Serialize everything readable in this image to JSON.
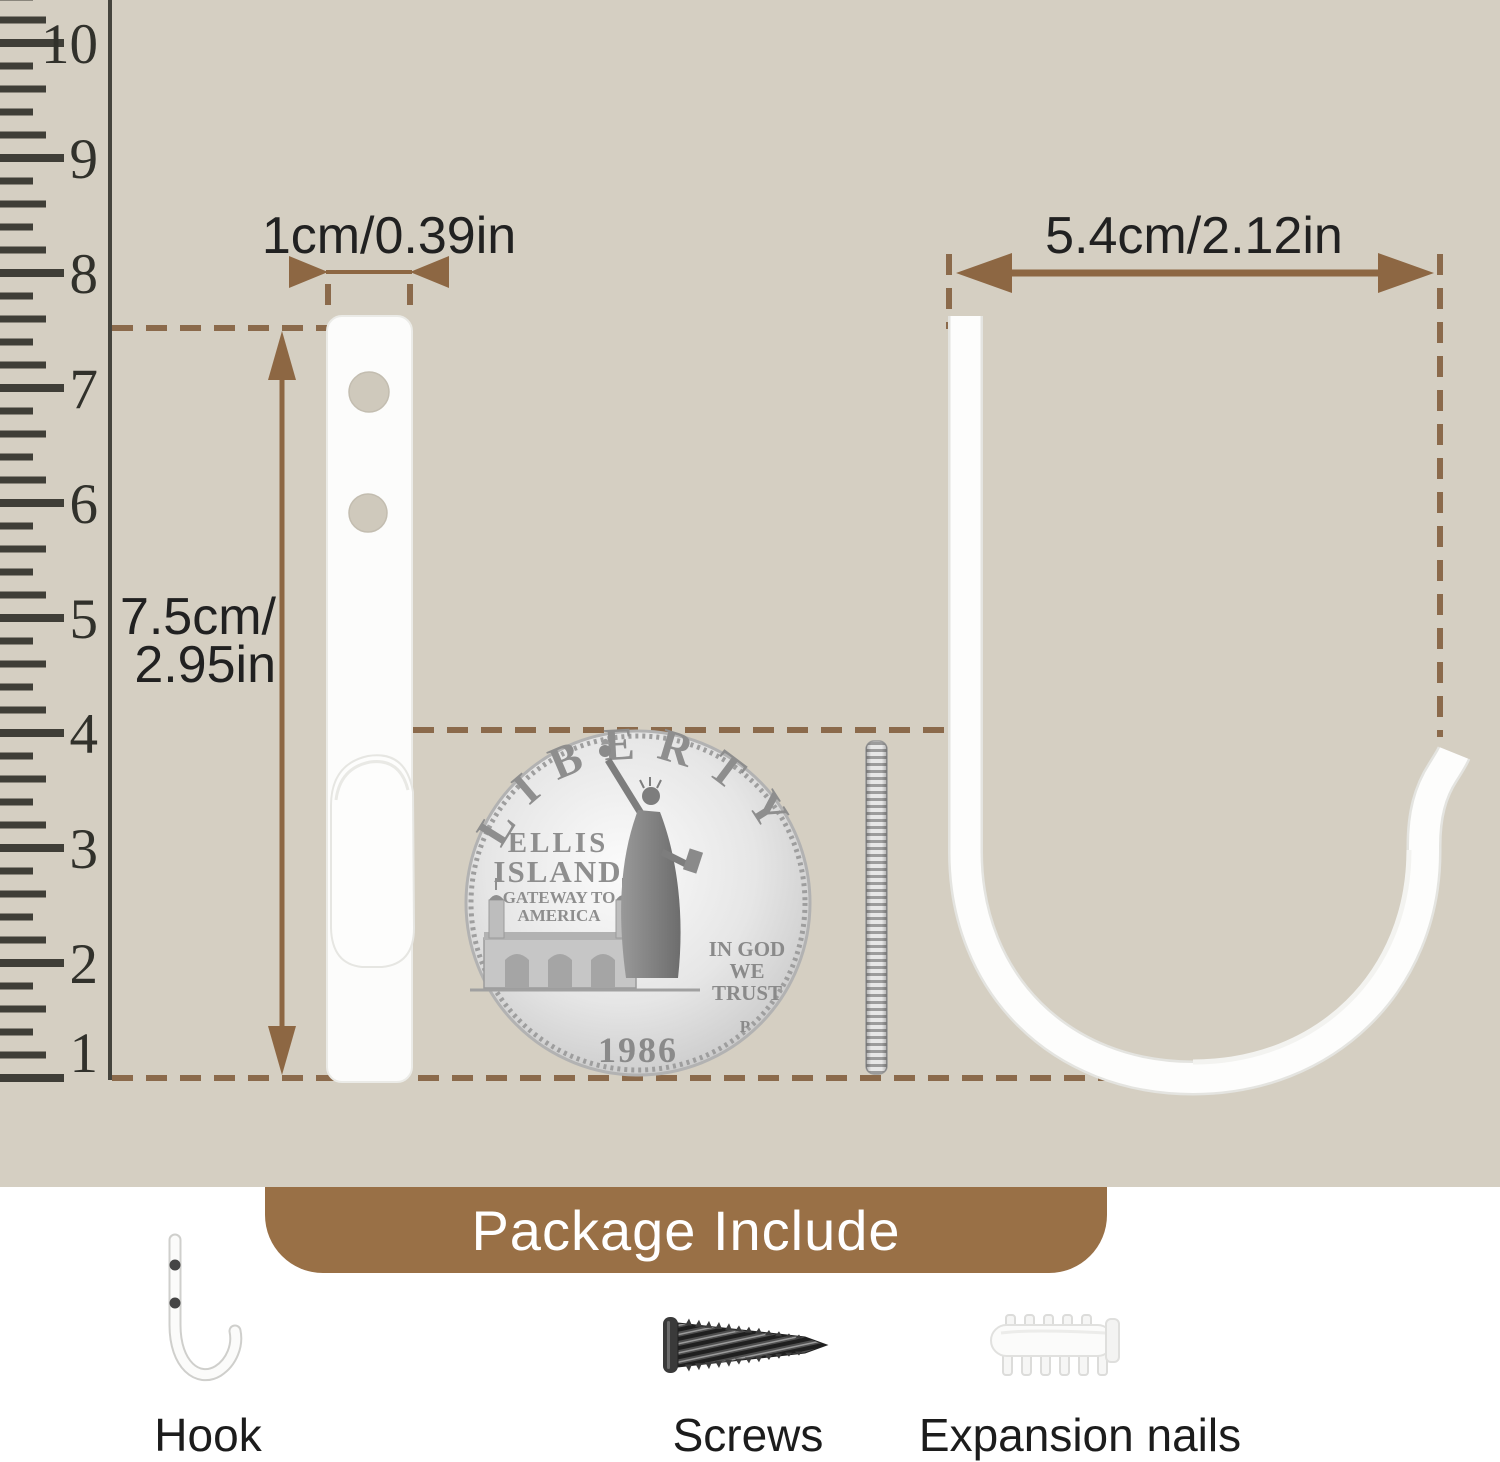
{
  "page": {
    "background_beige": "#d5cfc2"
  },
  "colors": {
    "accent_brown": "#8d6743",
    "dashed_brown": "#8b6a4b",
    "tab_brown": "#997046",
    "ruler_ink": "#3f3e37",
    "text_dark": "#212121",
    "hook_white": "#fcfcfb"
  },
  "ruler": {
    "numbers": [
      "10",
      "9",
      "8",
      "7",
      "6",
      "5",
      "4",
      "3",
      "2",
      "1"
    ]
  },
  "dimensions": {
    "small_width": "1cm/0.39in",
    "height_line1": "7.5cm/",
    "height_line2": "2.95in",
    "large_width": "5.4cm/2.12in"
  },
  "coin": {
    "legend": "LIBERTY",
    "line1": "ELLIS",
    "line2": "ISLAND",
    "line3": "GATEWAY TO",
    "line4": "AMERICA",
    "motto_line1": "IN GOD",
    "motto_line2": "WE",
    "motto_line3": "TRUST",
    "mint_mark": "P",
    "year": "1986"
  },
  "package": {
    "title": "Package Include",
    "items": [
      {
        "label": "Hook"
      },
      {
        "label": "Screws"
      },
      {
        "label": "Expansion nails"
      }
    ]
  }
}
